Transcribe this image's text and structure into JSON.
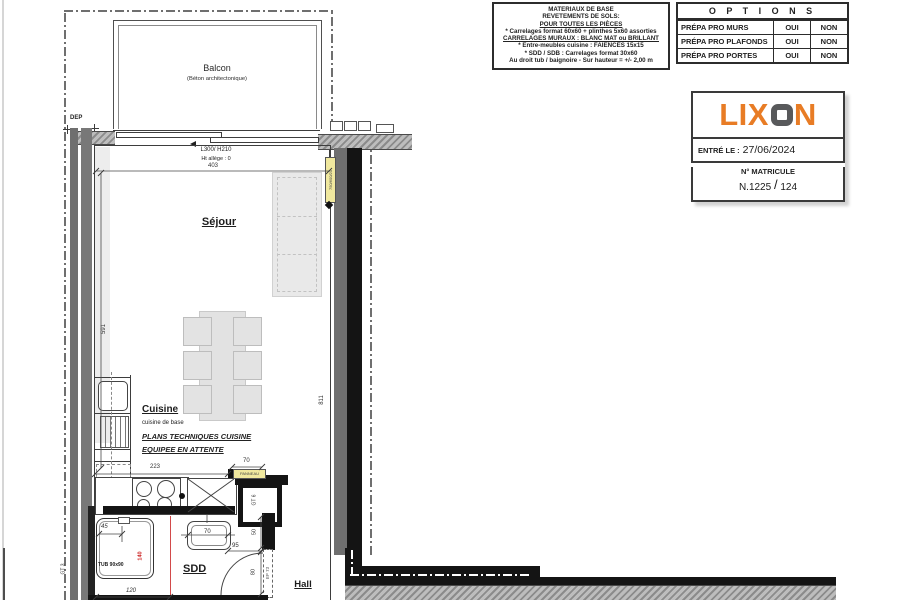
{
  "colors": {
    "brand_orange": "#E87C25",
    "logo_gray": "#58595B",
    "highlight_yellow": "#F0E89E",
    "dimension_red": "#CC2222"
  },
  "materials_box": {
    "lines": [
      "MATERIAUX DE BASE",
      "REVETEMENTS DE SOLS:",
      "POUR TOUTES LES PIÈCES",
      "* Carrelages format 60x60 + plinthes 5x60 assorties",
      "CARRELAGES MURAUX :  BLANC MAT ou BRILLANT",
      "* Entre-meubles cuisine : FAIENCES 15x15",
      "* SDD / SDB : Carrelages format 30x60",
      "Au droit tub / baignoire - Sur hauteur = +/- 2,00 m"
    ]
  },
  "options_table": {
    "title": "O P T I O N S",
    "rows": [
      {
        "label": "PRÉPA PRO MURS",
        "yes": "OUI",
        "no": "NON"
      },
      {
        "label": "PRÉPA PRO PLAFONDS",
        "yes": "OUI",
        "no": "NON"
      },
      {
        "label": "PRÉPA PRO PORTES",
        "yes": "OUI",
        "no": "NON"
      }
    ]
  },
  "title_block": {
    "logo_prefix": "LIX",
    "logo_suffix": "N",
    "entry_label": "ENTRÉ LE :",
    "entry_date": "27/06/2024",
    "matricule_label": "N° MATRICULE",
    "matricule_number": "N.1225",
    "matricule_slash": "/",
    "matricule_suffix": "124"
  },
  "plan": {
    "balcony_title": "Balcon",
    "balcony_subtitle": "(Béton architectonique)",
    "dep": "DEP",
    "window_size": "L300/ H210",
    "window_allege": "Ht allège : 0",
    "rooms": {
      "sejour": "Séjour",
      "cuisine": "Cuisine",
      "cuisine_sub": "cuisine de base",
      "sdd": "SDD",
      "hall": "Hall"
    },
    "notes": {
      "l1": "PLANS TECHNIQUES CUISINE",
      "l2": "EQUIPEE EN ATTENTE"
    },
    "fixtures": {
      "tub": "TUB 90x90"
    },
    "dims": {
      "d403": "403",
      "d591": "591",
      "d811": "811",
      "d223": "223",
      "d70_kitchen": "70",
      "d45": "45",
      "d140": "140",
      "d120": "120",
      "d70_basin": "70",
      "d95": "95",
      "d50": "50",
      "d80": "80"
    },
    "shafts": {
      "gt3": "GT 3",
      "gt6": "GT 6",
      "ep73": "EP 73"
    },
    "tags": {
      "radiator": "750/600/20",
      "kitchen": "PANNEAU"
    }
  }
}
